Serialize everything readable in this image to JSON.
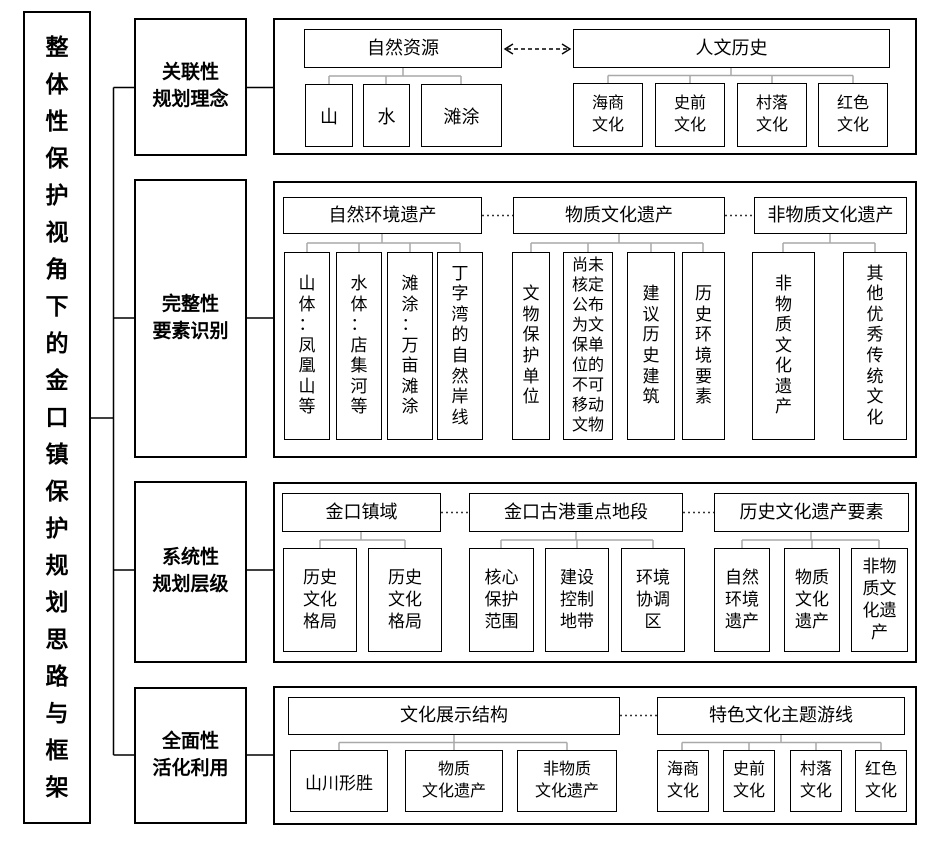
{
  "title": "整体性保护视角下的金口镇保护规划思路与框架",
  "sections": [
    {
      "label": "关联性\n规划理念"
    },
    {
      "label": "完整性\n要素识别"
    },
    {
      "label": "系统性\n规划层级"
    },
    {
      "label": "全面性\n活化利用"
    }
  ],
  "panel1": {
    "natural": {
      "header": "自然资源",
      "children": [
        "山",
        "水",
        "滩涂"
      ]
    },
    "human": {
      "header": "人文历史",
      "children": [
        "海商\n文化",
        "史前\n文化",
        "村落\n文化",
        "红色\n文化"
      ]
    }
  },
  "panel2": {
    "natural_env": {
      "header": "自然环境遗产",
      "children": [
        "山体：凤凰山等",
        "水体：店集河等",
        "滩涂：万亩滩涂",
        "丁字湾的自然岸线"
      ]
    },
    "material": {
      "header": "物质文化遗产",
      "children": [
        "文物保护单位",
        "尚未核定公布为文保单位的不可移动文物",
        "建议历史建筑",
        "历史环境要素"
      ]
    },
    "intangible": {
      "header": "非物质文化遗产",
      "children": [
        "非物质文化遗产",
        "其他优秀传统文化"
      ]
    }
  },
  "panel3": {
    "town": {
      "header": "金口镇域",
      "children": [
        "历史\n文化\n格局",
        "历史\n文化\n格局"
      ]
    },
    "port": {
      "header": "金口古港重点地段",
      "children": [
        "核心\n保护\n范围",
        "建设\n控制\n地带",
        "环境\n协调\n区"
      ]
    },
    "heritage": {
      "header": "历史文化遗产要素",
      "children": [
        "自然\n环境\n遗产",
        "物质\n文化\n遗产",
        "非物\n质文\n化遗\n产"
      ]
    }
  },
  "panel4": {
    "display": {
      "header": "文化展示结构",
      "children": [
        "山川形胜",
        "物质\n文化遗产",
        "非物质\n文化遗产"
      ]
    },
    "routes": {
      "header": "特色文化主题游线",
      "children": [
        "海商\n文化",
        "史前\n文化",
        "村落\n文化",
        "红色\n文化"
      ]
    }
  },
  "colors": {
    "border": "#000000",
    "tree_connector": "#a9a9a9",
    "dotted_connector": "#333333",
    "text": "#000000"
  }
}
